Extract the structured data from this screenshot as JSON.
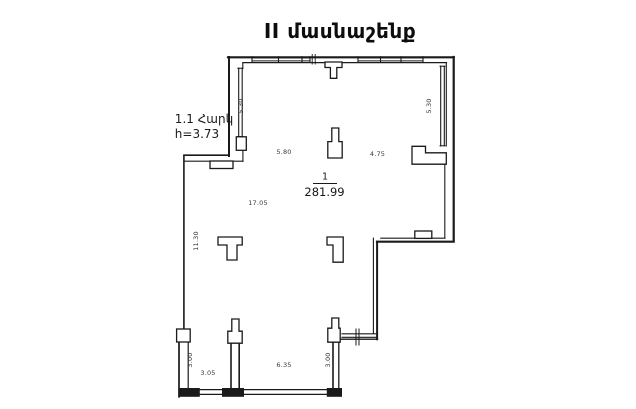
{
  "title": "II մասնաշենք",
  "annotations": {
    "floor": "1.1 Հարկ",
    "ceiling_height": "h=3.73"
  },
  "room": {
    "number": "1",
    "area": "281.99"
  },
  "dimensions": {
    "left_window": "5.30",
    "right_window": "5.30",
    "upper_width": "5.80",
    "upper_right_width": "4.75",
    "main_width": "17.05",
    "left_height": "11.30",
    "bay_left_height": "3.00",
    "bay_left_width": "3.05",
    "bay_middle_width": "6.35",
    "bay_right_height": "3.00"
  },
  "colors": {
    "line": "#1a1a1a",
    "dim_text": "#3a3a3a",
    "background": "#ffffff"
  }
}
